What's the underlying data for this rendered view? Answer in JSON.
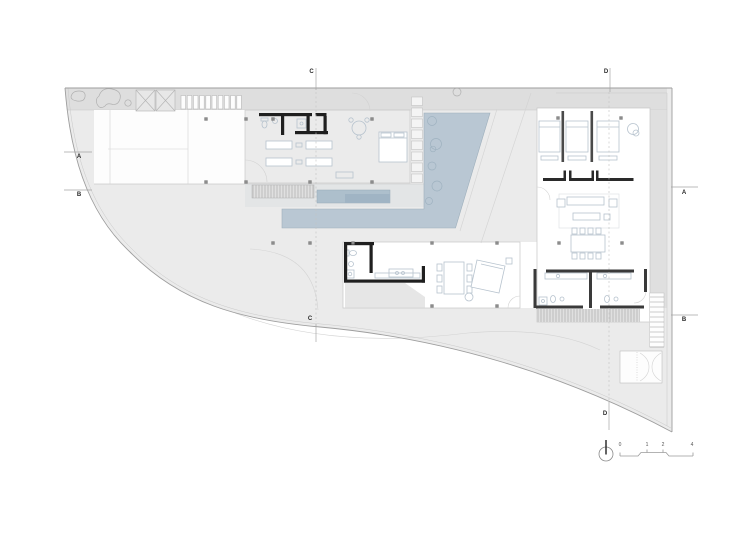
{
  "plan": {
    "section_markers": {
      "c_top": "C",
      "d_top": "D",
      "a_left": "A",
      "b_left": "B",
      "a_right": "A",
      "b_right": "B",
      "c_bottom": "C",
      "d_bottom": "D"
    },
    "scale_bar": {
      "tick_0": "0",
      "tick_1": "1",
      "tick_2": "2",
      "tick_4": "4"
    },
    "colors": {
      "site_fill": "#ebebeb",
      "band_fill": "#dedede",
      "deck_fill": "#e3e5e6",
      "pool_fill": "#b9c7d3",
      "lap_pool_fill": "#adbfcc",
      "lap_pool_inner": "#a0b4c4",
      "wall_color": "#1f1f1f",
      "furniture_line": "#b7c3ce",
      "boundary_line": "#9e9e9e"
    },
    "icons": {
      "north_arrow": "north-arrow"
    }
  }
}
